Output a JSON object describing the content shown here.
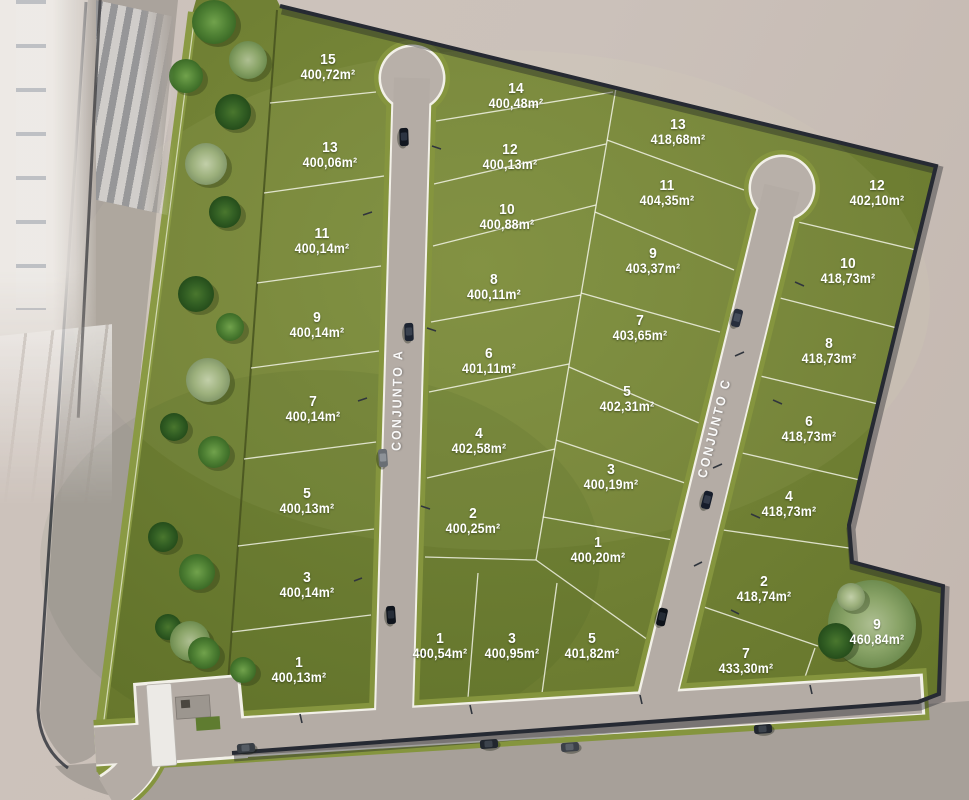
{
  "scene": {
    "description": "Aerial 3D masterplan render of a residential land subdivision with two internal streets and numbered lots",
    "area_unit_suffix": "m²",
    "streets": [
      {
        "id": "conjunto-a",
        "label": "CONJUNTO A"
      },
      {
        "id": "conjunto-c",
        "label": "CONJUNTO C"
      }
    ],
    "colors": {
      "lawn": "#6f7f33",
      "road": "#b4aca5",
      "verge_green": "#85953e",
      "boundary_wall": "#262a33",
      "outside_ground": "#c9bfb8",
      "label_text": "#ffffff"
    },
    "lot_groups": [
      {
        "name": "west-of-conjunto-a",
        "lots": [
          {
            "number": "15",
            "area": "400,72m²",
            "x": 328,
            "y": 67
          },
          {
            "number": "13",
            "area": "400,06m²",
            "x": 330,
            "y": 155
          },
          {
            "number": "11",
            "area": "400,14m²",
            "x": 322,
            "y": 241
          },
          {
            "number": "9",
            "area": "400,14m²",
            "x": 317,
            "y": 325
          },
          {
            "number": "7",
            "area": "400,14m²",
            "x": 313,
            "y": 409
          },
          {
            "number": "5",
            "area": "400,13m²",
            "x": 307,
            "y": 501
          },
          {
            "number": "3",
            "area": "400,14m²",
            "x": 307,
            "y": 585
          },
          {
            "number": "1",
            "area": "400,13m²",
            "x": 299,
            "y": 670
          }
        ]
      },
      {
        "name": "east-of-conjunto-a",
        "lots": [
          {
            "number": "14",
            "area": "400,48m²",
            "x": 516,
            "y": 96
          },
          {
            "number": "12",
            "area": "400,13m²",
            "x": 510,
            "y": 157
          },
          {
            "number": "10",
            "area": "400,88m²",
            "x": 507,
            "y": 217
          },
          {
            "number": "8",
            "area": "400,11m²",
            "x": 494,
            "y": 287
          },
          {
            "number": "6",
            "area": "401,11m²",
            "x": 489,
            "y": 361
          },
          {
            "number": "4",
            "area": "402,58m²",
            "x": 479,
            "y": 441
          },
          {
            "number": "2",
            "area": "400,25m²",
            "x": 473,
            "y": 521
          }
        ]
      },
      {
        "name": "south-row",
        "lots": [
          {
            "number": "1",
            "area": "400,54m²",
            "x": 440,
            "y": 646
          },
          {
            "number": "3",
            "area": "400,95m²",
            "x": 512,
            "y": 646
          },
          {
            "number": "5",
            "area": "401,82m²",
            "x": 592,
            "y": 646
          }
        ]
      },
      {
        "name": "west-of-conjunto-c",
        "lots": [
          {
            "number": "13",
            "area": "418,68m²",
            "x": 678,
            "y": 132
          },
          {
            "number": "11",
            "area": "404,35m²",
            "x": 667,
            "y": 193
          },
          {
            "number": "9",
            "area": "403,37m²",
            "x": 653,
            "y": 261
          },
          {
            "number": "7",
            "area": "403,65m²",
            "x": 640,
            "y": 328
          },
          {
            "number": "5",
            "area": "402,31m²",
            "x": 627,
            "y": 399
          },
          {
            "number": "3",
            "area": "400,19m²",
            "x": 611,
            "y": 477
          },
          {
            "number": "1",
            "area": "400,20m²",
            "x": 598,
            "y": 550
          }
        ]
      },
      {
        "name": "east-of-conjunto-c",
        "lots": [
          {
            "number": "12",
            "area": "402,10m²",
            "x": 877,
            "y": 193
          },
          {
            "number": "10",
            "area": "418,73m²",
            "x": 848,
            "y": 271
          },
          {
            "number": "8",
            "area": "418,73m²",
            "x": 829,
            "y": 351
          },
          {
            "number": "6",
            "area": "418,73m²",
            "x": 809,
            "y": 429
          },
          {
            "number": "4",
            "area": "418,73m²",
            "x": 789,
            "y": 504
          },
          {
            "number": "2",
            "area": "418,74m²",
            "x": 764,
            "y": 589
          },
          {
            "number": "7",
            "area": "433,30m²",
            "x": 746,
            "y": 661
          },
          {
            "number": "9",
            "area": "460,84m²",
            "x": 877,
            "y": 632
          }
        ]
      }
    ]
  }
}
